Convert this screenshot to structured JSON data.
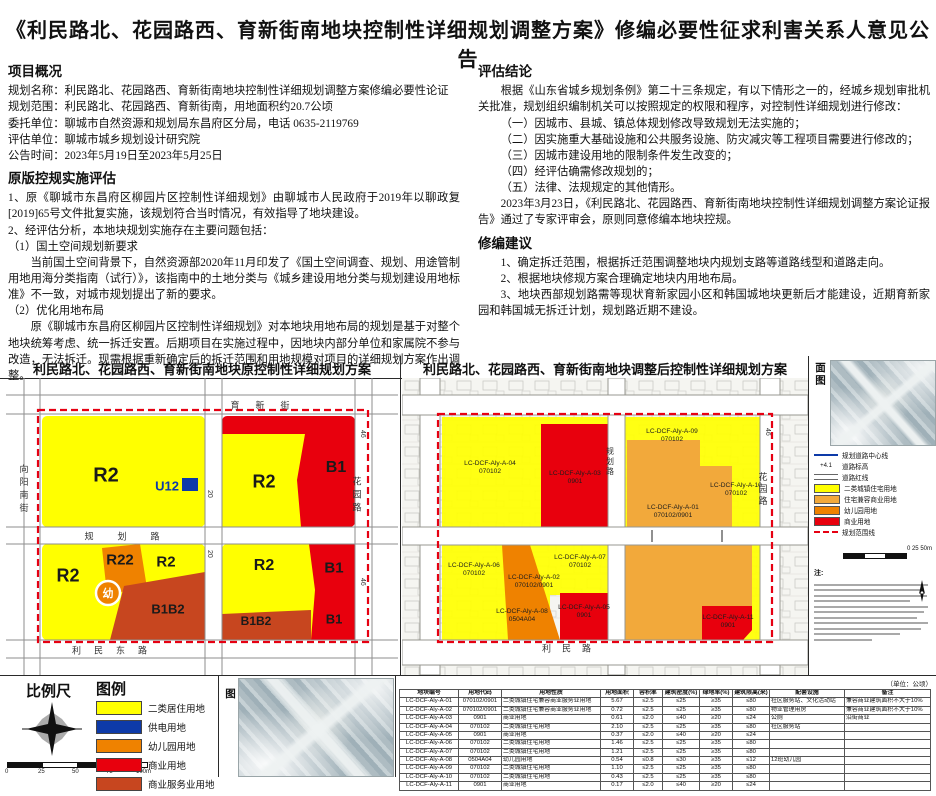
{
  "title": "《利民路北、花园路西、育新街南地块控制性详细规划调整方案》修编必要性征求利害关系人意见公告",
  "colors": {
    "yellow": "#ffff00",
    "gold": "#f2a93b",
    "orange": "#ef8200",
    "red": "#e8000d",
    "brick": "#c7461f",
    "blue": "#0d3aa8",
    "boundary": "#e60012"
  },
  "left": {
    "overview": {
      "heading": "项目概况",
      "lines": [
        "规划名称：利民路北、花园路西、育新街南地块控制性详细规划调整方案修编必要性论证",
        "规划范围：利民路北、花园路西、育新街南，用地面积约20.7公顷",
        "委托单位：聊城市自然资源和规划局东昌府区分局，电话 0635-2119769",
        "评估单位：聊城市城乡规划设计研究院",
        "公告时间：2023年5月19日至2023年5月25日"
      ]
    },
    "eval": {
      "heading": "原版控规实施评估",
      "paras": [
        "1、原《聊城市东昌府区柳园片区控制性详细规划》由聊城市人民政府于2019年以聊政复[2019]65号文件批复实施，该规划符合当时情况，有效指导了地块建设。",
        "2、经评估分析，本地块规划实施存在主要问题包括：",
        "（1）国土空间规划新要求",
        "当前国土空间背景下，自然资源部2020年11月印发了《国土空间调查、规划、用途管制用地用海分类指南（试行）》，该指南中的土地分类与《城乡建设用地分类与规划建设用地标准》不一致，对城市规划提出了新的要求。",
        "（2）优化用地布局",
        "原《聊城市东昌府区柳园片区控制性详细规划》对本地块用地布局的规划是基于对整个地块统筹考虑、统一拆迁安置。后期项目在实施过程中，因地块内部分单位和家属院不参与改造，无法拆迁。现需根据重新确定后的拆迁范围和用地规模对项目的详细规划方案作出调整。"
      ]
    }
  },
  "right": {
    "conclusion": {
      "heading": "评估结论",
      "p1": "根据《山东省城乡规划条例》第二十三条规定，有以下情形之一的，经城乡规划审批机关批准，规划组织编制机关可以按照规定的权限和程序，对控制性详细规划进行修改：",
      "items": [
        "（一）因城市、县城、镇总体规划修改导致规划无法实施的；",
        "（二）因实施重大基础设施和公共服务设施、防灾减灾等工程项目需要进行修改的；",
        "（三）因城市建设用地的限制条件发生改变的；",
        "（四）经评估确需修改规划的；",
        "（五）法律、法规规定的其他情形。"
      ],
      "p2": "2023年3月23日，《利民路北、花园路西、育新街南地块控制性详细规划调整方案论证报告》通过了专家评审会，原则同意修编本地块控规。"
    },
    "suggestion": {
      "heading": "修编建议",
      "paras": [
        "1、确定拆迁范围，根据拆迁范围调整地块内规划支路等道路线型和道路走向。",
        "2、根据地块修规方案合理确定地块内用地布局。",
        "3、地块西部规划路需等现状育新家园小区和韩国城地块更新后才能建设，近期育新家园和韩国城无拆迁计划，规划路近期不建设。"
      ]
    }
  },
  "maps": {
    "left": {
      "title": "利民路北、花园路西、育新街南地块原控制性详细规划方案",
      "labels": {
        "r2": "R2",
        "r22": "R22",
        "b1": "B1",
        "b1b2": "B1B2",
        "u": "U12",
        "kind": "幼"
      },
      "roads": {
        "top": "育新街",
        "left": "向阳南街",
        "middle": "规划路",
        "bottom": "利民东路",
        "right": "花园路",
        "w20": "20",
        "w46": "46"
      }
    },
    "right": {
      "title": "利民路北、花园路西、育新街南地块调整后控制性详细规划方案",
      "parcels": [
        {
          "code": "LC-DCF-Aly-A-04",
          "use": "070102"
        },
        {
          "code": "LC-DCF-Aly-A-03",
          "use": "0901"
        },
        {
          "code": "LC-DCF-Aly-A-09",
          "use": "070102"
        },
        {
          "code": "LC-DCF-Aly-A-10",
          "use": "070102"
        },
        {
          "code": "LC-DCF-Aly-A-01",
          "use": "070102/0901"
        },
        {
          "code": "LC-DCF-Aly-A-06",
          "use": "070102"
        },
        {
          "code": "LC-DCF-Aly-A-02",
          "use": "070102/0901"
        },
        {
          "code": "LC-DCF-Aly-A-07",
          "use": "070102"
        },
        {
          "code": "LC-DCF-Aly-A-08",
          "use": "0504A04"
        },
        {
          "code": "LC-DCF-Aly-A-05",
          "use": "0901"
        },
        {
          "code": "LC-DCF-Aly-A-11",
          "use": "0901"
        }
      ],
      "roads": {
        "bottom": "利民路",
        "right": "花园路",
        "center": "规划路",
        "w46": "46"
      }
    }
  },
  "side": {
    "plan_label": "城市设计总平面图",
    "legend": [
      {
        "label": "规划道路中心线"
      },
      {
        "label": "道路标高",
        "symbol": "+4.1"
      },
      {
        "label": "道路红线"
      },
      {
        "label": "二类城镇住宅用地"
      },
      {
        "label": "住宅兼容商业用地"
      },
      {
        "label": "幼儿园用地"
      },
      {
        "label": "商业用地"
      },
      {
        "label": "规划范围线"
      }
    ],
    "note_heading": "注:",
    "mini_scale": "0    25    50m"
  },
  "bottom": {
    "scale": {
      "heading": "比例尺",
      "ticks": [
        "0",
        "25",
        "50",
        "75",
        "100m"
      ]
    },
    "legend": {
      "heading": "图例",
      "items": [
        {
          "label": "二类居住用地"
        },
        {
          "label": "供电用地"
        },
        {
          "label": "幼儿园用地"
        },
        {
          "label": "商业用地"
        },
        {
          "label": "商业服务业用地"
        }
      ]
    },
    "bird_label": "城市设计鸟瞰图"
  },
  "table": {
    "unit_note": "（单位：公顷）",
    "headers": [
      "地块编号",
      "用地代码",
      "用地性质",
      "用地面积",
      "容积率",
      "建筑密度(%)",
      "绿地率(%)",
      "建筑限高(米)",
      "配套设施",
      "备注"
    ],
    "rows": [
      [
        "LC-DCF-Aly-A-01",
        "070102/0901",
        "二类城镇住宅兼容商业服务业用地",
        "5.67",
        "≤2.5",
        "≤25",
        "≥35",
        "≤80",
        "社区服务站、文化活动站",
        "兼容商业建筑面积不大于10%"
      ],
      [
        "LC-DCF-Aly-A-02",
        "070102/0901",
        "二类城镇住宅兼容商业服务业用地",
        "0.72",
        "≤2.5",
        "≤25",
        "≥35",
        "≤80",
        "物业管理用房",
        "兼容商业建筑面积不大于10%"
      ],
      [
        "LC-DCF-Aly-A-03",
        "0901",
        "商业用地",
        "0.61",
        "≤2.0",
        "≤40",
        "≥20",
        "≤24",
        "公厕",
        "沿街商业"
      ],
      [
        "LC-DCF-Aly-A-04",
        "070102",
        "二类城镇住宅用地",
        "2.10",
        "≤2.5",
        "≤25",
        "≥35",
        "≤80",
        "社区服务站",
        ""
      ],
      [
        "LC-DCF-Aly-A-05",
        "0901",
        "商业用地",
        "0.37",
        "≤2.0",
        "≤40",
        "≥20",
        "≤24",
        "",
        ""
      ],
      [
        "LC-DCF-Aly-A-06",
        "070102",
        "二类城镇住宅用地",
        "1.46",
        "≤2.5",
        "≤25",
        "≥35",
        "≤80",
        "",
        ""
      ],
      [
        "LC-DCF-Aly-A-07",
        "070102",
        "二类城镇住宅用地",
        "1.21",
        "≤2.5",
        "≤25",
        "≥35",
        "≤80",
        "",
        ""
      ],
      [
        "LC-DCF-Aly-A-08",
        "0504A04",
        "幼儿园用地",
        "0.54",
        "≤0.8",
        "≤30",
        "≥35",
        "≤12",
        "12班幼儿园",
        ""
      ],
      [
        "LC-DCF-Aly-A-09",
        "070102",
        "二类城镇住宅用地",
        "1.10",
        "≤2.5",
        "≤25",
        "≥35",
        "≤80",
        "",
        ""
      ],
      [
        "LC-DCF-Aly-A-10",
        "070102",
        "二类城镇住宅用地",
        "0.43",
        "≤2.5",
        "≤25",
        "≥35",
        "≤80",
        "",
        ""
      ],
      [
        "LC-DCF-Aly-A-11",
        "0901",
        "商业用地",
        "0.17",
        "≤2.0",
        "≤40",
        "≥20",
        "≤24",
        "",
        ""
      ]
    ]
  }
}
